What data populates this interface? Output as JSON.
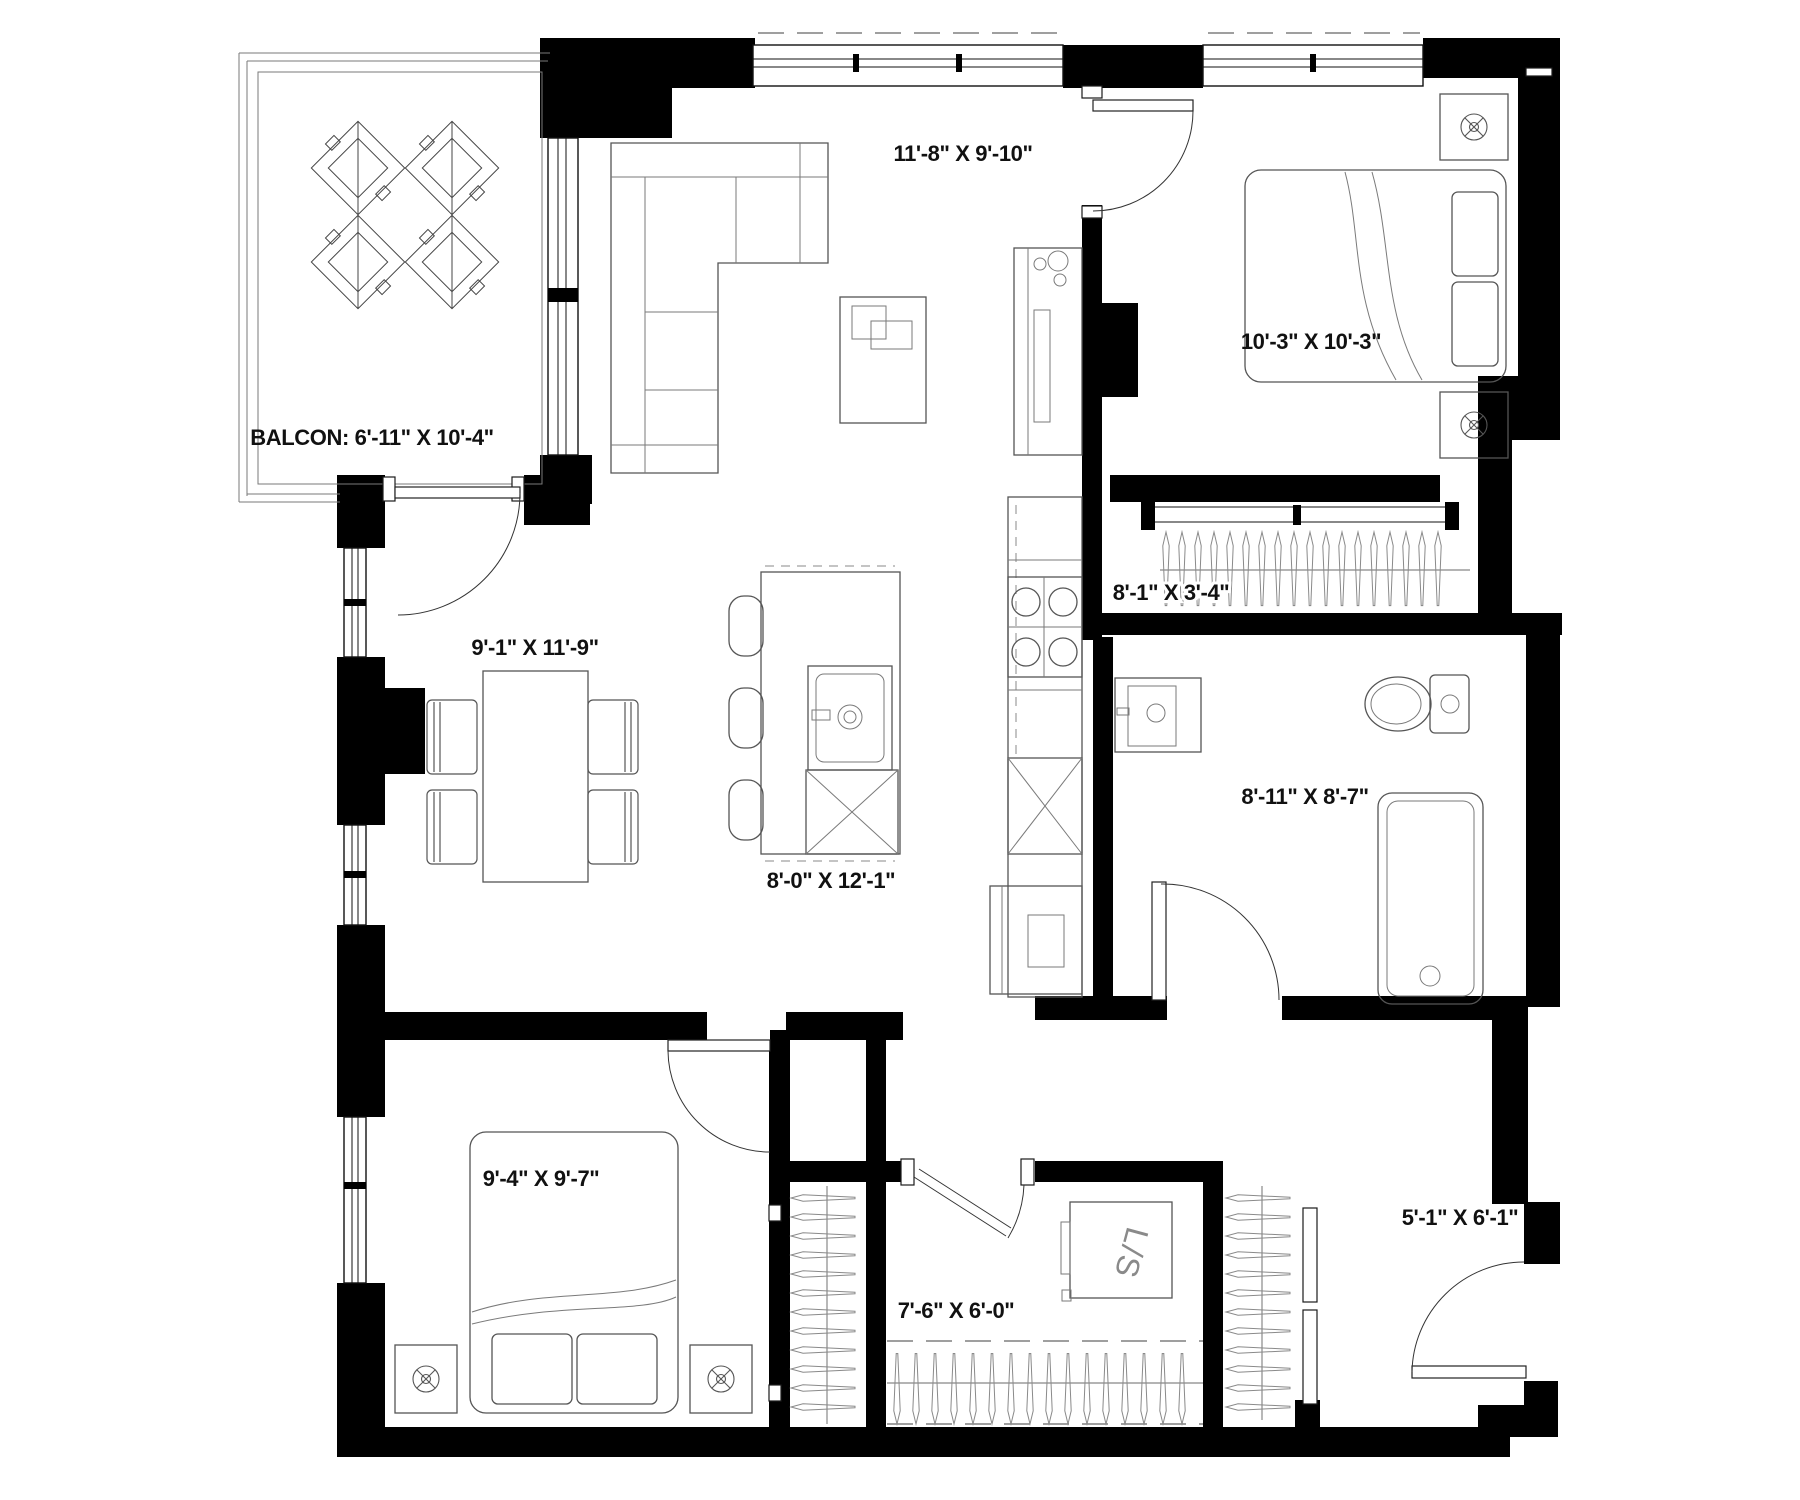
{
  "plan": {
    "type": "apartment-floor-plan",
    "colors": {
      "walls": "#000000",
      "furniture_line": "#555555",
      "thin_line": "#888888",
      "background": "#ffffff",
      "text": "#111111"
    },
    "rooms": {
      "balcony": {
        "name": "balcony",
        "label": "BALCON: 6'-11\" X 10'-4\""
      },
      "living": {
        "name": "living-room",
        "label": "11'-8\" X 9'-10\""
      },
      "bedroom1": {
        "name": "bedroom-1",
        "label": "10'-3\" X 10'-3\""
      },
      "closet1": {
        "name": "bedroom-closet",
        "label": "8'-1\" X 3'-4\""
      },
      "bathroom": {
        "name": "bathroom",
        "label": "8'-11\" X 8'-7\""
      },
      "kitchen": {
        "name": "kitchen",
        "label": "8'-0\" X 12'-1\""
      },
      "dining": {
        "name": "dining-room",
        "label": "9'-1\" X 11'-9\""
      },
      "bedroom2": {
        "name": "bedroom-2",
        "label": "9'-4\" X 9'-7\""
      },
      "walkin": {
        "name": "walk-in-closet",
        "label": "7'-6\" X 6'-0\""
      },
      "entry": {
        "name": "entry",
        "label": "5'-1\" X 6'-1\""
      }
    },
    "appliances": {
      "washer_dryer": "L/S"
    }
  }
}
